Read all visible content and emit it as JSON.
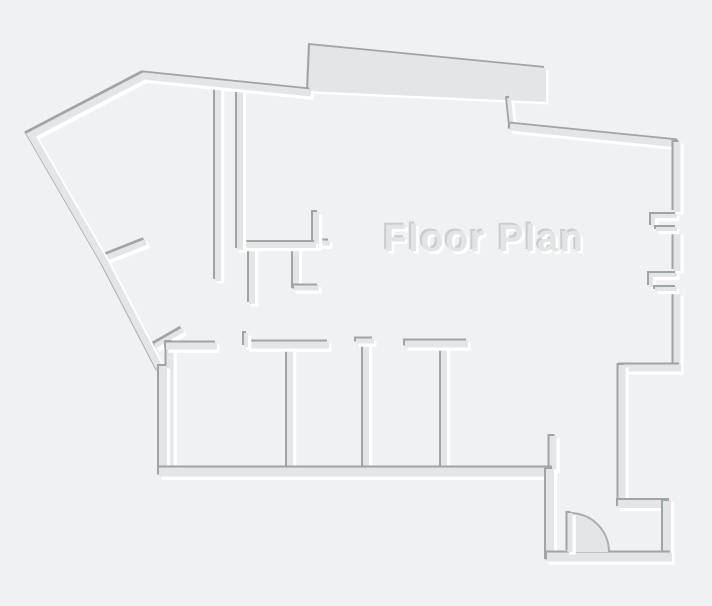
{
  "page": {
    "background": "#f0f1f2",
    "width": 712,
    "height": 606
  },
  "plan": {
    "title": {
      "text": "Floor Plan",
      "x": 484,
      "y": 251,
      "font_size": 38
    },
    "colors": {
      "background": "#f0f1f2",
      "wall_fill": "#e3e5e6",
      "shadow_dark": "#9fa4a6",
      "highlight_white": "#ffffff",
      "text_fill": "#e2e4e5",
      "text_shadow_dark": "#c9cdce",
      "arc_stroke": "#a9adaf"
    },
    "emboss": {
      "dark_offset": -2,
      "light_offset": 2.5,
      "light_extra_width": 1.5
    },
    "layers": [
      {
        "kind": "wall",
        "name": "closet-wall-e",
        "w": 6,
        "pts": [
          [
            252,
            247
          ],
          [
            252,
            304
          ]
        ]
      },
      {
        "kind": "wall",
        "name": "closet-wall-f",
        "w": 6,
        "pts": [
          [
            296,
            247
          ],
          [
            296,
            290
          ]
        ]
      },
      {
        "kind": "wall",
        "name": "closet-wall-f-foot",
        "w": 5,
        "pts": [
          [
            294,
            288
          ],
          [
            319,
            288
          ]
        ]
      },
      {
        "kind": "wall",
        "name": "jamb-stub",
        "w": 5,
        "pts": [
          [
            320,
            243
          ],
          [
            330,
            243
          ]
        ]
      },
      {
        "kind": "wall",
        "name": "kitchen-wall-riser",
        "w": 6,
        "pts": [
          [
            316,
            248
          ],
          [
            316,
            212
          ]
        ]
      },
      {
        "kind": "wall",
        "name": "kitchen-wall-horizontal",
        "w": 6,
        "pts": [
          [
            237,
            245
          ],
          [
            316,
            245
          ]
        ]
      },
      {
        "kind": "wall",
        "name": "hall-wall-a",
        "w": 6,
        "pts": [
          [
            218,
            87
          ],
          [
            218,
            281
          ]
        ]
      },
      {
        "kind": "wall",
        "name": "hall-wall-b",
        "w": 6,
        "pts": [
          [
            240,
            89
          ],
          [
            240,
            250
          ]
        ]
      },
      {
        "kind": "wall",
        "name": "diagonal-stub-upper",
        "w": 6,
        "pts": [
          [
            103,
            259
          ],
          [
            146,
            242
          ]
        ]
      },
      {
        "kind": "wall",
        "name": "diagonal-stub-lower",
        "w": 5,
        "pts": [
          [
            155,
            346
          ],
          [
            183,
            330
          ]
        ]
      },
      {
        "kind": "wall",
        "name": "room1-left-wall",
        "w": 7,
        "pts": [
          [
            170,
            342
          ],
          [
            170,
            470
          ]
        ]
      },
      {
        "kind": "wall",
        "name": "room-divider-1",
        "w": 6,
        "pts": [
          [
            290,
            342
          ],
          [
            290,
            470
          ]
        ]
      },
      {
        "kind": "wall",
        "name": "room-divider-2",
        "w": 6,
        "pts": [
          [
            366,
            340
          ],
          [
            366,
            470
          ]
        ]
      },
      {
        "kind": "wall",
        "name": "room-divider-3",
        "w": 6,
        "pts": [
          [
            444,
            346
          ],
          [
            444,
            470
          ]
        ]
      },
      {
        "kind": "wall",
        "name": "room-end-stub",
        "w": 7,
        "pts": [
          [
            553,
            436
          ],
          [
            553,
            471
          ]
        ]
      },
      {
        "kind": "wall",
        "name": "room1-top-wall",
        "w": 7,
        "pts": [
          [
            166,
            346
          ],
          [
            217,
            346
          ]
        ]
      },
      {
        "kind": "wall",
        "name": "room2-top-wall",
        "w": 7,
        "pts": [
          [
            247,
            345
          ],
          [
            329,
            345
          ]
        ]
      },
      {
        "kind": "wall",
        "name": "room2-top-jog",
        "w": 4,
        "pts": [
          [
            246,
            347
          ],
          [
            246,
            333
          ]
        ]
      },
      {
        "kind": "wall",
        "name": "divider2-cap",
        "w": 5,
        "pts": [
          [
            356,
            341
          ],
          [
            374,
            341
          ]
        ]
      },
      {
        "kind": "wall",
        "name": "room3-top-wall",
        "w": 7,
        "pts": [
          [
            405,
            344
          ],
          [
            468,
            344
          ]
        ]
      },
      {
        "kind": "polygon",
        "name": "top-thick-band",
        "pts": [
          [
            310,
            45
          ],
          [
            546,
            68
          ],
          [
            546,
            102
          ],
          [
            308,
            91
          ]
        ]
      },
      {
        "kind": "wall",
        "name": "outer-wall-left",
        "w": 7,
        "pts": [
          [
            311,
            93
          ],
          [
            144,
            76
          ],
          [
            31,
            135
          ],
          [
            105,
            263
          ],
          [
            161,
            371
          ]
        ]
      },
      {
        "kind": "wall",
        "name": "outer-wall-left-vertical",
        "w": 8,
        "pts": [
          [
            163,
            366
          ],
          [
            163,
            472
          ]
        ]
      },
      {
        "kind": "wall",
        "name": "top-band-connector",
        "w": 4,
        "pts": [
          [
            509,
            98
          ],
          [
            512,
            127
          ]
        ]
      },
      {
        "kind": "wall",
        "name": "outer-wall-top-right",
        "w": 7,
        "pts": [
          [
            510,
            127
          ],
          [
            679,
            144
          ]
        ]
      },
      {
        "kind": "wall",
        "name": "outer-wall-right-upper",
        "w": 7,
        "pts": [
          [
            677,
            142
          ],
          [
            677,
            212
          ]
        ]
      },
      {
        "kind": "wall",
        "name": "outer-wall-right-mid",
        "w": 7,
        "pts": [
          [
            677,
            232
          ],
          [
            677,
            271
          ]
        ]
      },
      {
        "kind": "wall",
        "name": "outer-wall-right-lower",
        "w": 7,
        "pts": [
          [
            677,
            293
          ],
          [
            677,
            371
          ]
        ]
      },
      {
        "kind": "wall",
        "name": "window1-jamb-upper",
        "w": 4,
        "pts": [
          [
            653,
            227
          ],
          [
            653,
            216
          ],
          [
            677,
            216
          ]
        ]
      },
      {
        "kind": "wall",
        "name": "window1-jamb-lower",
        "w": 4,
        "pts": [
          [
            656,
            229
          ],
          [
            677,
            229
          ]
        ]
      },
      {
        "kind": "wall",
        "name": "window2-jamb-upper",
        "w": 4,
        "pts": [
          [
            651,
            287
          ],
          [
            651,
            275
          ],
          [
            677,
            275
          ]
        ]
      },
      {
        "kind": "wall",
        "name": "window2-jamb-lower",
        "w": 4,
        "pts": [
          [
            655,
            289
          ],
          [
            677,
            289
          ]
        ]
      },
      {
        "kind": "wall",
        "name": "right-step-top",
        "w": 7,
        "pts": [
          [
            681,
            368
          ],
          [
            620,
            368
          ]
        ]
      },
      {
        "kind": "wall",
        "name": "outer-wall-right-step",
        "w": 7,
        "pts": [
          [
            622,
            365
          ],
          [
            622,
            507
          ]
        ]
      },
      {
        "kind": "wall",
        "name": "right-step-bottom",
        "w": 8,
        "pts": [
          [
            618,
            504
          ],
          [
            671,
            504
          ]
        ]
      },
      {
        "kind": "wall",
        "name": "vestibule-right-wall",
        "w": 8,
        "pts": [
          [
            667,
            501
          ],
          [
            667,
            559
          ]
        ]
      },
      {
        "kind": "wall",
        "name": "outer-wall-bottom",
        "w": 9,
        "pts": [
          [
            159,
            472
          ],
          [
            554,
            472
          ]
        ]
      },
      {
        "kind": "wall",
        "name": "vestibule-left-wall",
        "w": 8,
        "pts": [
          [
            550,
            561
          ],
          [
            550,
            469
          ]
        ]
      },
      {
        "kind": "wall",
        "name": "vestibule-bottom-wall",
        "w": 9,
        "pts": [
          [
            672,
            557
          ],
          [
            547,
            557
          ]
        ]
      },
      {
        "kind": "door-sector",
        "name": "door-swing-sector",
        "d": "M 570 513 A 39 39 0 0 1 609 552 L 570 552 Z"
      },
      {
        "kind": "door-arc",
        "name": "door-swing-arc",
        "d": "M 570 513 A 39 39 0 0 1 609 552"
      },
      {
        "kind": "wall",
        "name": "door-leaf",
        "w": 5,
        "pts": [
          [
            570,
            513
          ],
          [
            570,
            552
          ]
        ]
      }
    ]
  }
}
